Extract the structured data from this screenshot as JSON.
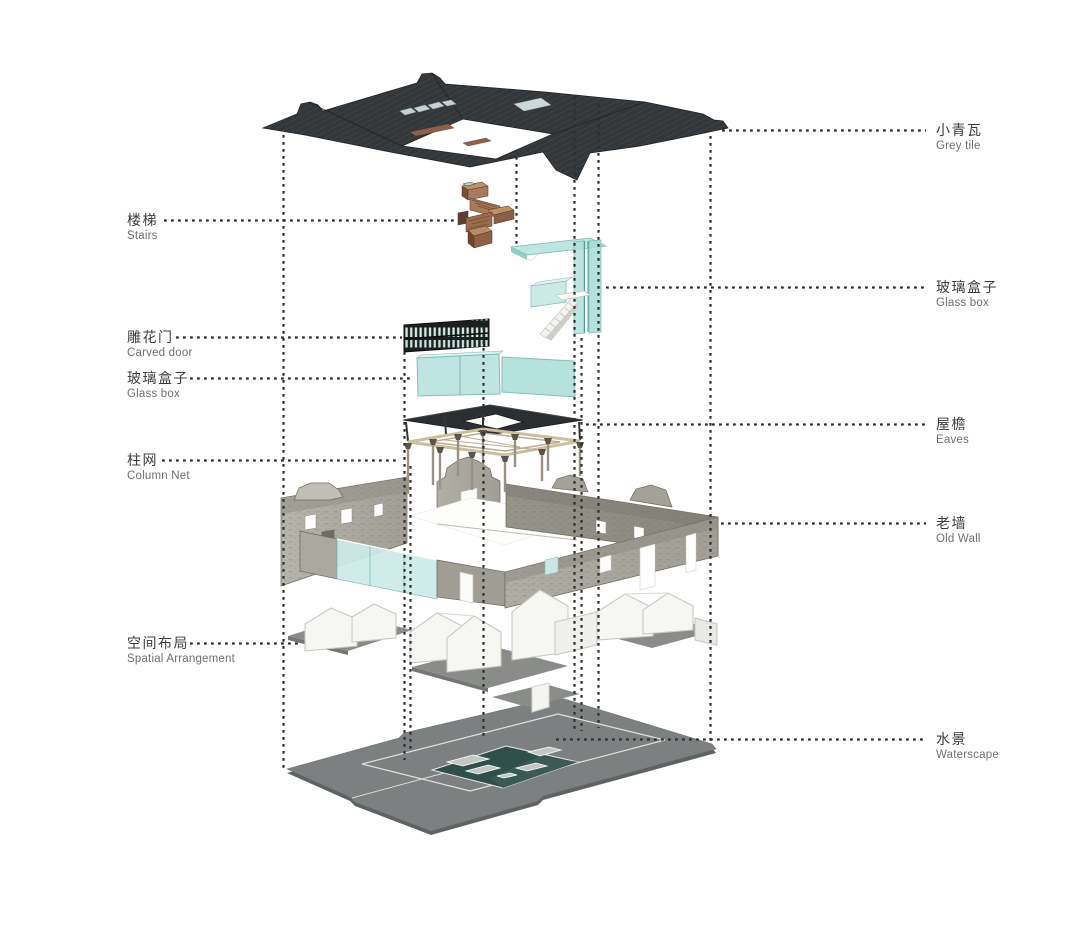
{
  "figure": {
    "kind": "exploded-axonometric-architecture-diagram",
    "background": "#ffffff"
  },
  "annotations": {
    "left": [
      {
        "zh": "楼梯",
        "en": "Stairs"
      },
      {
        "zh": "雕花门",
        "en": "Carved door"
      },
      {
        "zh": "玻璃盒子",
        "en": "Glass box"
      },
      {
        "zh": "柱网",
        "en": "Column Net"
      },
      {
        "zh": "空间布局",
        "en": "Spatial Arrangement"
      }
    ],
    "right": [
      {
        "zh": "小青瓦",
        "en": "Grey tile"
      },
      {
        "zh": "玻璃盒子",
        "en": "Glass box"
      },
      {
        "zh": "屋檐",
        "en": "Eaves"
      },
      {
        "zh": "老墙",
        "en": "Old Wall"
      },
      {
        "zh": "水景",
        "en": "Waterscape"
      }
    ]
  },
  "colors": {
    "roof": "#33373a",
    "glass": "#b9e3df",
    "glass_front": "#cdebe8",
    "wood": "#a97a5c",
    "stone": "#a8a69d",
    "base": "#7d8080",
    "pond": "#2f4f4b",
    "leader_line": "#2e2e2e",
    "label_zh": "#3c3c3c",
    "label_en": "#6f6f6f"
  }
}
